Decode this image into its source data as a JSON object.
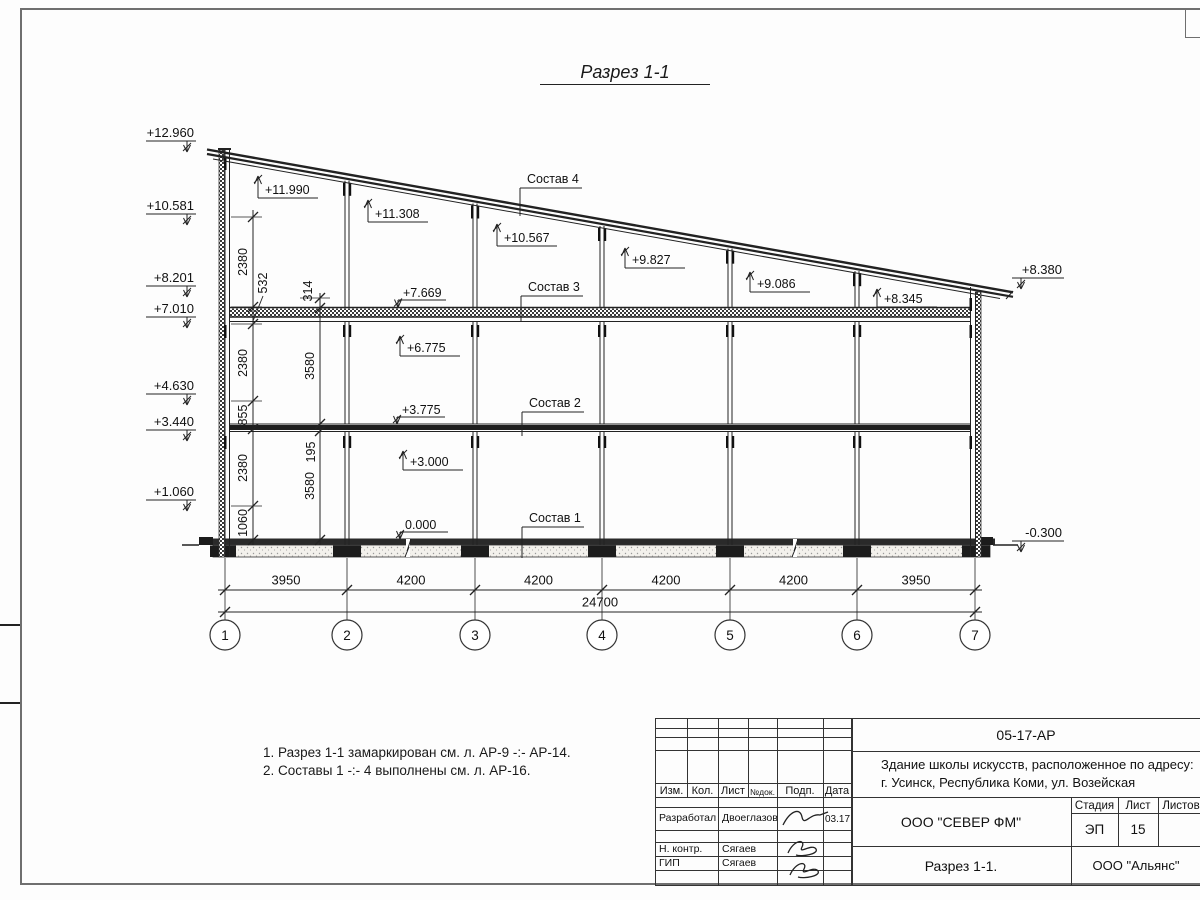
{
  "sheet": {
    "title": "Разрез 1-1",
    "notes": [
      "1. Разрез 1-1 замаркирован см. л. АР-9 -:- АР-14.",
      "2. Составы 1 -:- 4 выполнены см. л. АР-16."
    ]
  },
  "drawing": {
    "elevation_marks_left": [
      "+12.960",
      "+10.581",
      "+8.201",
      "+7.010",
      "+4.630",
      "+3.440",
      "+1.060"
    ],
    "elevation_marks_right": [
      "+8.380",
      "-0.300"
    ],
    "interior_marks_up": [
      "+11.990",
      "+11.308",
      "+10.567",
      "+9.827",
      "+9.086",
      "+8.345",
      "+6.775",
      "+3.000"
    ],
    "interior_marks_down": [
      "+7.669",
      "+3.775",
      "0.000"
    ],
    "layer_labels": [
      "Состав 4",
      "Состав 3",
      "Состав 2",
      "Состав 1"
    ],
    "dim_chain_wall": [
      "2380",
      "532",
      "2380",
      "855",
      "2380",
      "1060"
    ],
    "dim_chain_storey": [
      "314",
      "3580",
      "195",
      "3580"
    ],
    "span_dims": [
      "3950",
      "4200",
      "4200",
      "4200",
      "4200",
      "3950"
    ],
    "total_dim": "24700",
    "axis_labels": [
      "1",
      "2",
      "3",
      "4",
      "5",
      "6",
      "7"
    ]
  },
  "title_block": {
    "doc_number": "05-17-АР",
    "project_line1": "Здание школы искусств, расположенное по адресу:",
    "project_line2": "г. Усинск, Республика Коми, ул. Возейская",
    "columns": [
      "Изм.",
      "Кол.",
      "Лист",
      "№док.",
      "Подп.",
      "Дата"
    ],
    "roles": [
      {
        "role": "Разработал",
        "name": "Двоеглазов",
        "date": "03.17"
      },
      {
        "role": "Н. контр.",
        "name": "Сягаев",
        "date": ""
      },
      {
        "role": "ГИП",
        "name": "Сягаев",
        "date": ""
      }
    ],
    "designer_company": "ООО \"СЕВЕР ФМ\"",
    "stage_label": "Стадия",
    "sheet_label": "Лист",
    "sheets_label": "Листов",
    "stage_value": "ЭП",
    "sheet_value": "15",
    "sheets_value": "",
    "drawing_title": "Разрез 1-1.",
    "client_company": "ООО \"Альянс\""
  }
}
